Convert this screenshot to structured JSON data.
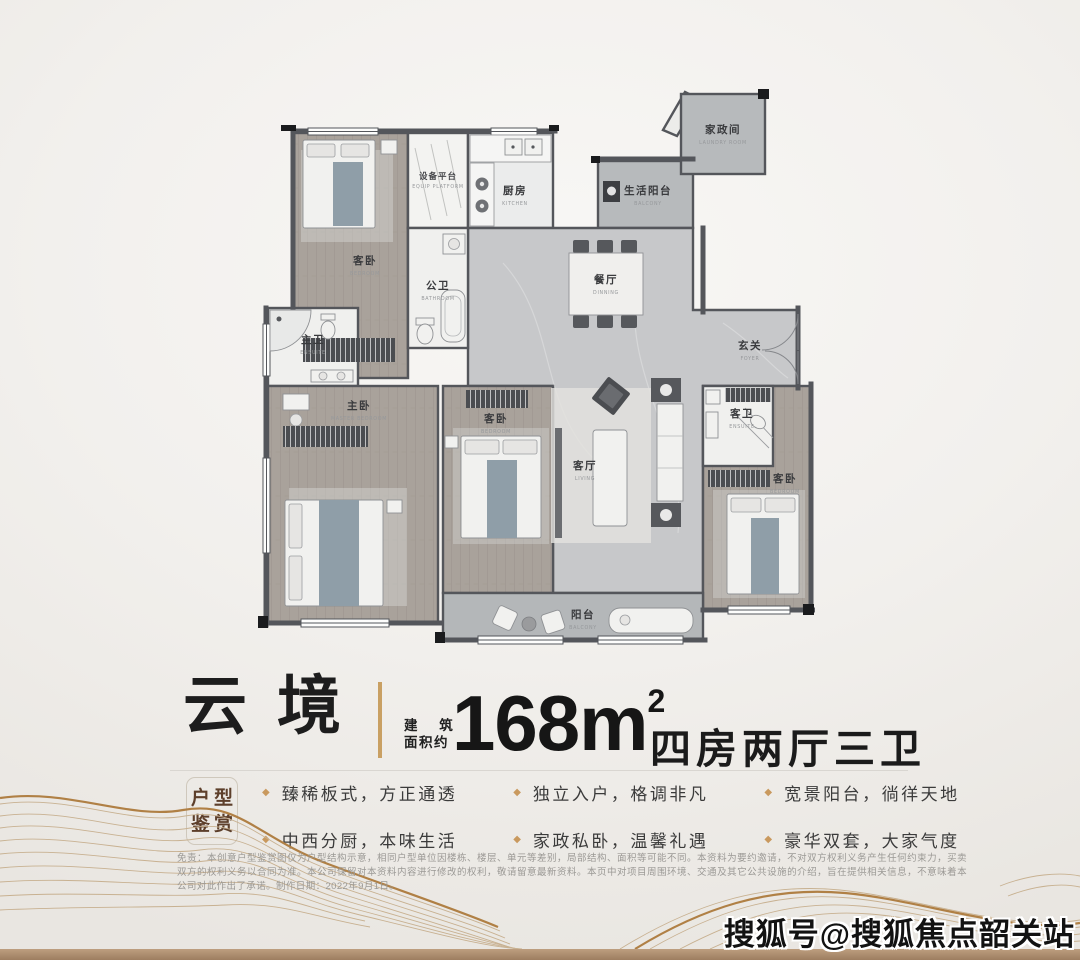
{
  "title": {
    "name": "云境",
    "area_prefix_top": "建 筑",
    "area_prefix_bottom": "面积约",
    "area_number": "168m",
    "area_superscript": "2",
    "layout": "四房两厅三卫"
  },
  "badge": {
    "top": "户型",
    "bottom": "鉴赏"
  },
  "features": {
    "bullet": "◆",
    "items": [
      "臻稀板式，方正通透",
      "中西分厨，本味生活",
      "独立入户，格调非凡",
      "家政私卧，温馨礼遇",
      "宽景阳台，徜徉天地",
      "豪华双套，大家气度"
    ]
  },
  "disclaimer": "免责：本创意户型鉴赏图仅为户型结构示意，相同户型单位因楼栋、楼层、单元等差别，局部结构、面积等可能不同。本资料为要约邀请，不对双方权利义务产生任何约束力，买卖双方的权利义务以合同为准。本公司保留对本资料内容进行修改的权利，敬请留意最新资料。本页中对项目周围环境、交通及其它公共设施的介绍，旨在提供相关信息，不意味着本公司对此作出了承诺。制作日期：2022年9月1日。",
  "watermark": "搜狐号@搜狐焦点韶关站",
  "plan": {
    "rooms": [
      {
        "zh": "客卧",
        "en": "BEDROOM"
      },
      {
        "zh": "设备平台",
        "en": "EQUIP PLATFORM"
      },
      {
        "zh": "厨房",
        "en": "KITCHEN"
      },
      {
        "zh": "生活阳台",
        "en": "BALCONY"
      },
      {
        "zh": "家政间",
        "en": "LAUNDRY ROOM"
      },
      {
        "zh": "餐厅",
        "en": "DINNING"
      },
      {
        "zh": "公卫",
        "en": "BATHROOM"
      },
      {
        "zh": "主卫",
        "en": "ENSUITE"
      },
      {
        "zh": "玄关",
        "en": "FOYER"
      },
      {
        "zh": "主卧",
        "en": "MASTER BEDROOM"
      },
      {
        "zh": "客卧",
        "en": "BEDROOM"
      },
      {
        "zh": "客厅",
        "en": "LIVING"
      },
      {
        "zh": "客卫",
        "en": "ENSUITE"
      },
      {
        "zh": "客卧",
        "en": "BEDROOM"
      },
      {
        "zh": "阳台",
        "en": "BALCONY"
      }
    ]
  },
  "colors": {
    "accent_gold": "#c9a063",
    "wall_gray": "#54565b",
    "bottom_bar": "#ab8a6c",
    "badge_text": "#5d3f2b"
  }
}
